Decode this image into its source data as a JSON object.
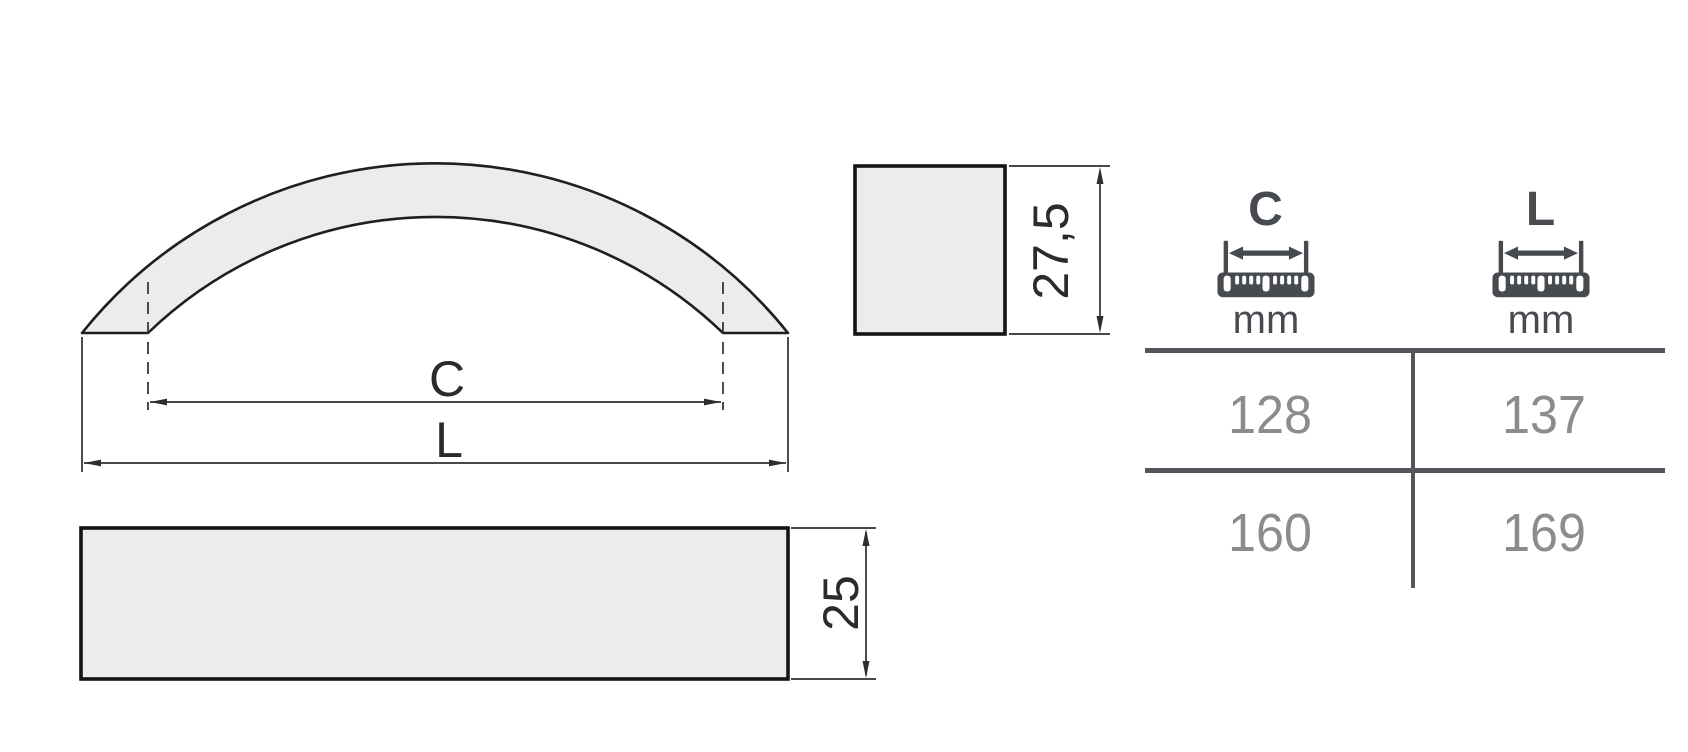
{
  "page": {
    "background": "#ffffff"
  },
  "drawing": {
    "fill_color": "#ececec",
    "line_color": "#1f1f1f",
    "dimension_color": "#2e2e2e",
    "front_view": {
      "c_label": "C",
      "l_label": "L"
    },
    "side_view": {
      "height_value": "27,5"
    },
    "bottom_view": {
      "height_value": "25"
    }
  },
  "table": {
    "rule_color": "#53565a",
    "header_color": "#474b50",
    "value_color": "#8c8c8c",
    "columns": [
      {
        "label": "C",
        "unit": "mm",
        "icon": "ruler-mm-icon"
      },
      {
        "label": "L",
        "unit": "mm",
        "icon": "ruler-mm-icon"
      }
    ],
    "rows": [
      {
        "c": "128",
        "l": "137"
      },
      {
        "c": "160",
        "l": "169"
      }
    ]
  }
}
